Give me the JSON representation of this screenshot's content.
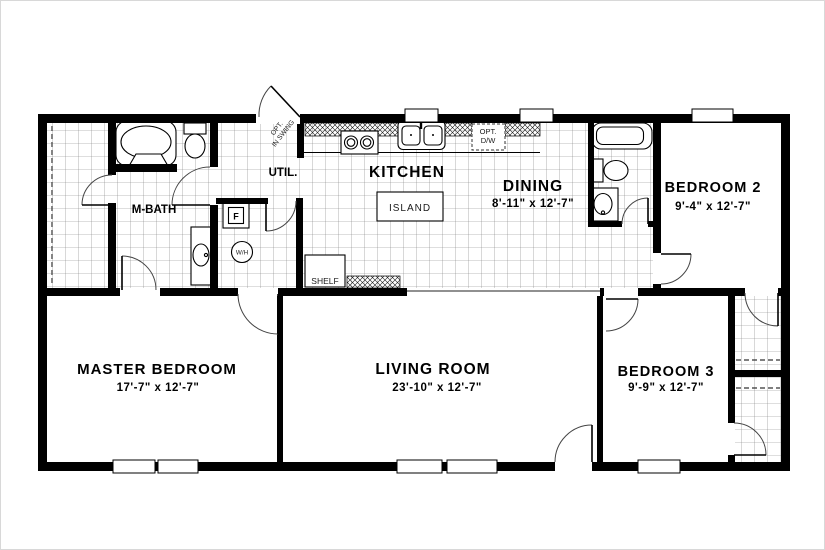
{
  "plan": {
    "rooms": {
      "m_bath": {
        "label": "M-BATH"
      },
      "util": {
        "label": "UTIL."
      },
      "kitchen": {
        "label": "KITCHEN"
      },
      "dining": {
        "label": "DINING",
        "dims": "8'-11\" x  12'-7\""
      },
      "bedroom2": {
        "label": "BEDROOM 2",
        "dims": "9'-4\" x  12'-7\""
      },
      "master": {
        "label": "MASTER BEDROOM",
        "dims": "17'-7\" x  12'-7\""
      },
      "living": {
        "label": "LIVING ROOM",
        "dims": "23'-10\" x  12'-7\""
      },
      "bedroom3": {
        "label": "BEDROOM 3",
        "dims": "9'-9\" x  12'-7\""
      }
    },
    "fixtures": {
      "island": "ISLAND",
      "shelf": "SHELF",
      "furnace": "F",
      "water_heater": "W/H",
      "opt_dw_line1": "OPT.",
      "opt_dw_line2": "D/W",
      "opt_inswing_line1": "OPT.",
      "opt_inswing_line2": "IN SWING"
    },
    "colors": {
      "wall": "#000000",
      "floor_grid": "#7d7d7d",
      "background": "#ffffff"
    }
  }
}
